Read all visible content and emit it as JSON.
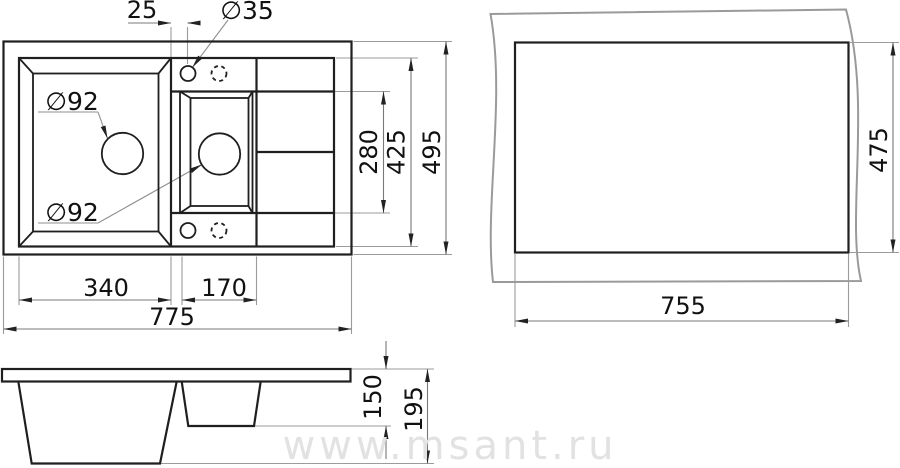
{
  "drawing": {
    "type": "kitchen sink installation drawing, three views",
    "watermark": {
      "text": "www.msant.ru",
      "color": "#e2e2e2"
    },
    "colors": {
      "background": "#ffffff",
      "object_line": "#1f1f1f",
      "context_line": "#9a9a9a",
      "dimension_line": "#787878",
      "extension_line": "#9b9b9b",
      "arrow": "#222222",
      "text": "#111111"
    },
    "top_view": {
      "description": "sink plan view with two bowls, faucet holes and drainboard",
      "dimensions": {
        "faucet_offset": "25",
        "faucet_hole_diameter": "∅35",
        "main_drain_diameter": "∅92",
        "small_drain_diameter": "∅92",
        "small_bowl_length": "280",
        "bowl_zone_length": "425",
        "overall_depth": "495",
        "main_bowl_width": "340",
        "small_bowl_width": "170",
        "overall_width": "775"
      }
    },
    "cutout_view": {
      "description": "countertop cutout",
      "dimensions": {
        "cutout_depth": "475",
        "cutout_width": "755"
      }
    },
    "side_view": {
      "description": "front elevation with bowl depths",
      "dimensions": {
        "small_bowl_depth": "150",
        "main_bowl_depth": "195"
      }
    }
  }
}
